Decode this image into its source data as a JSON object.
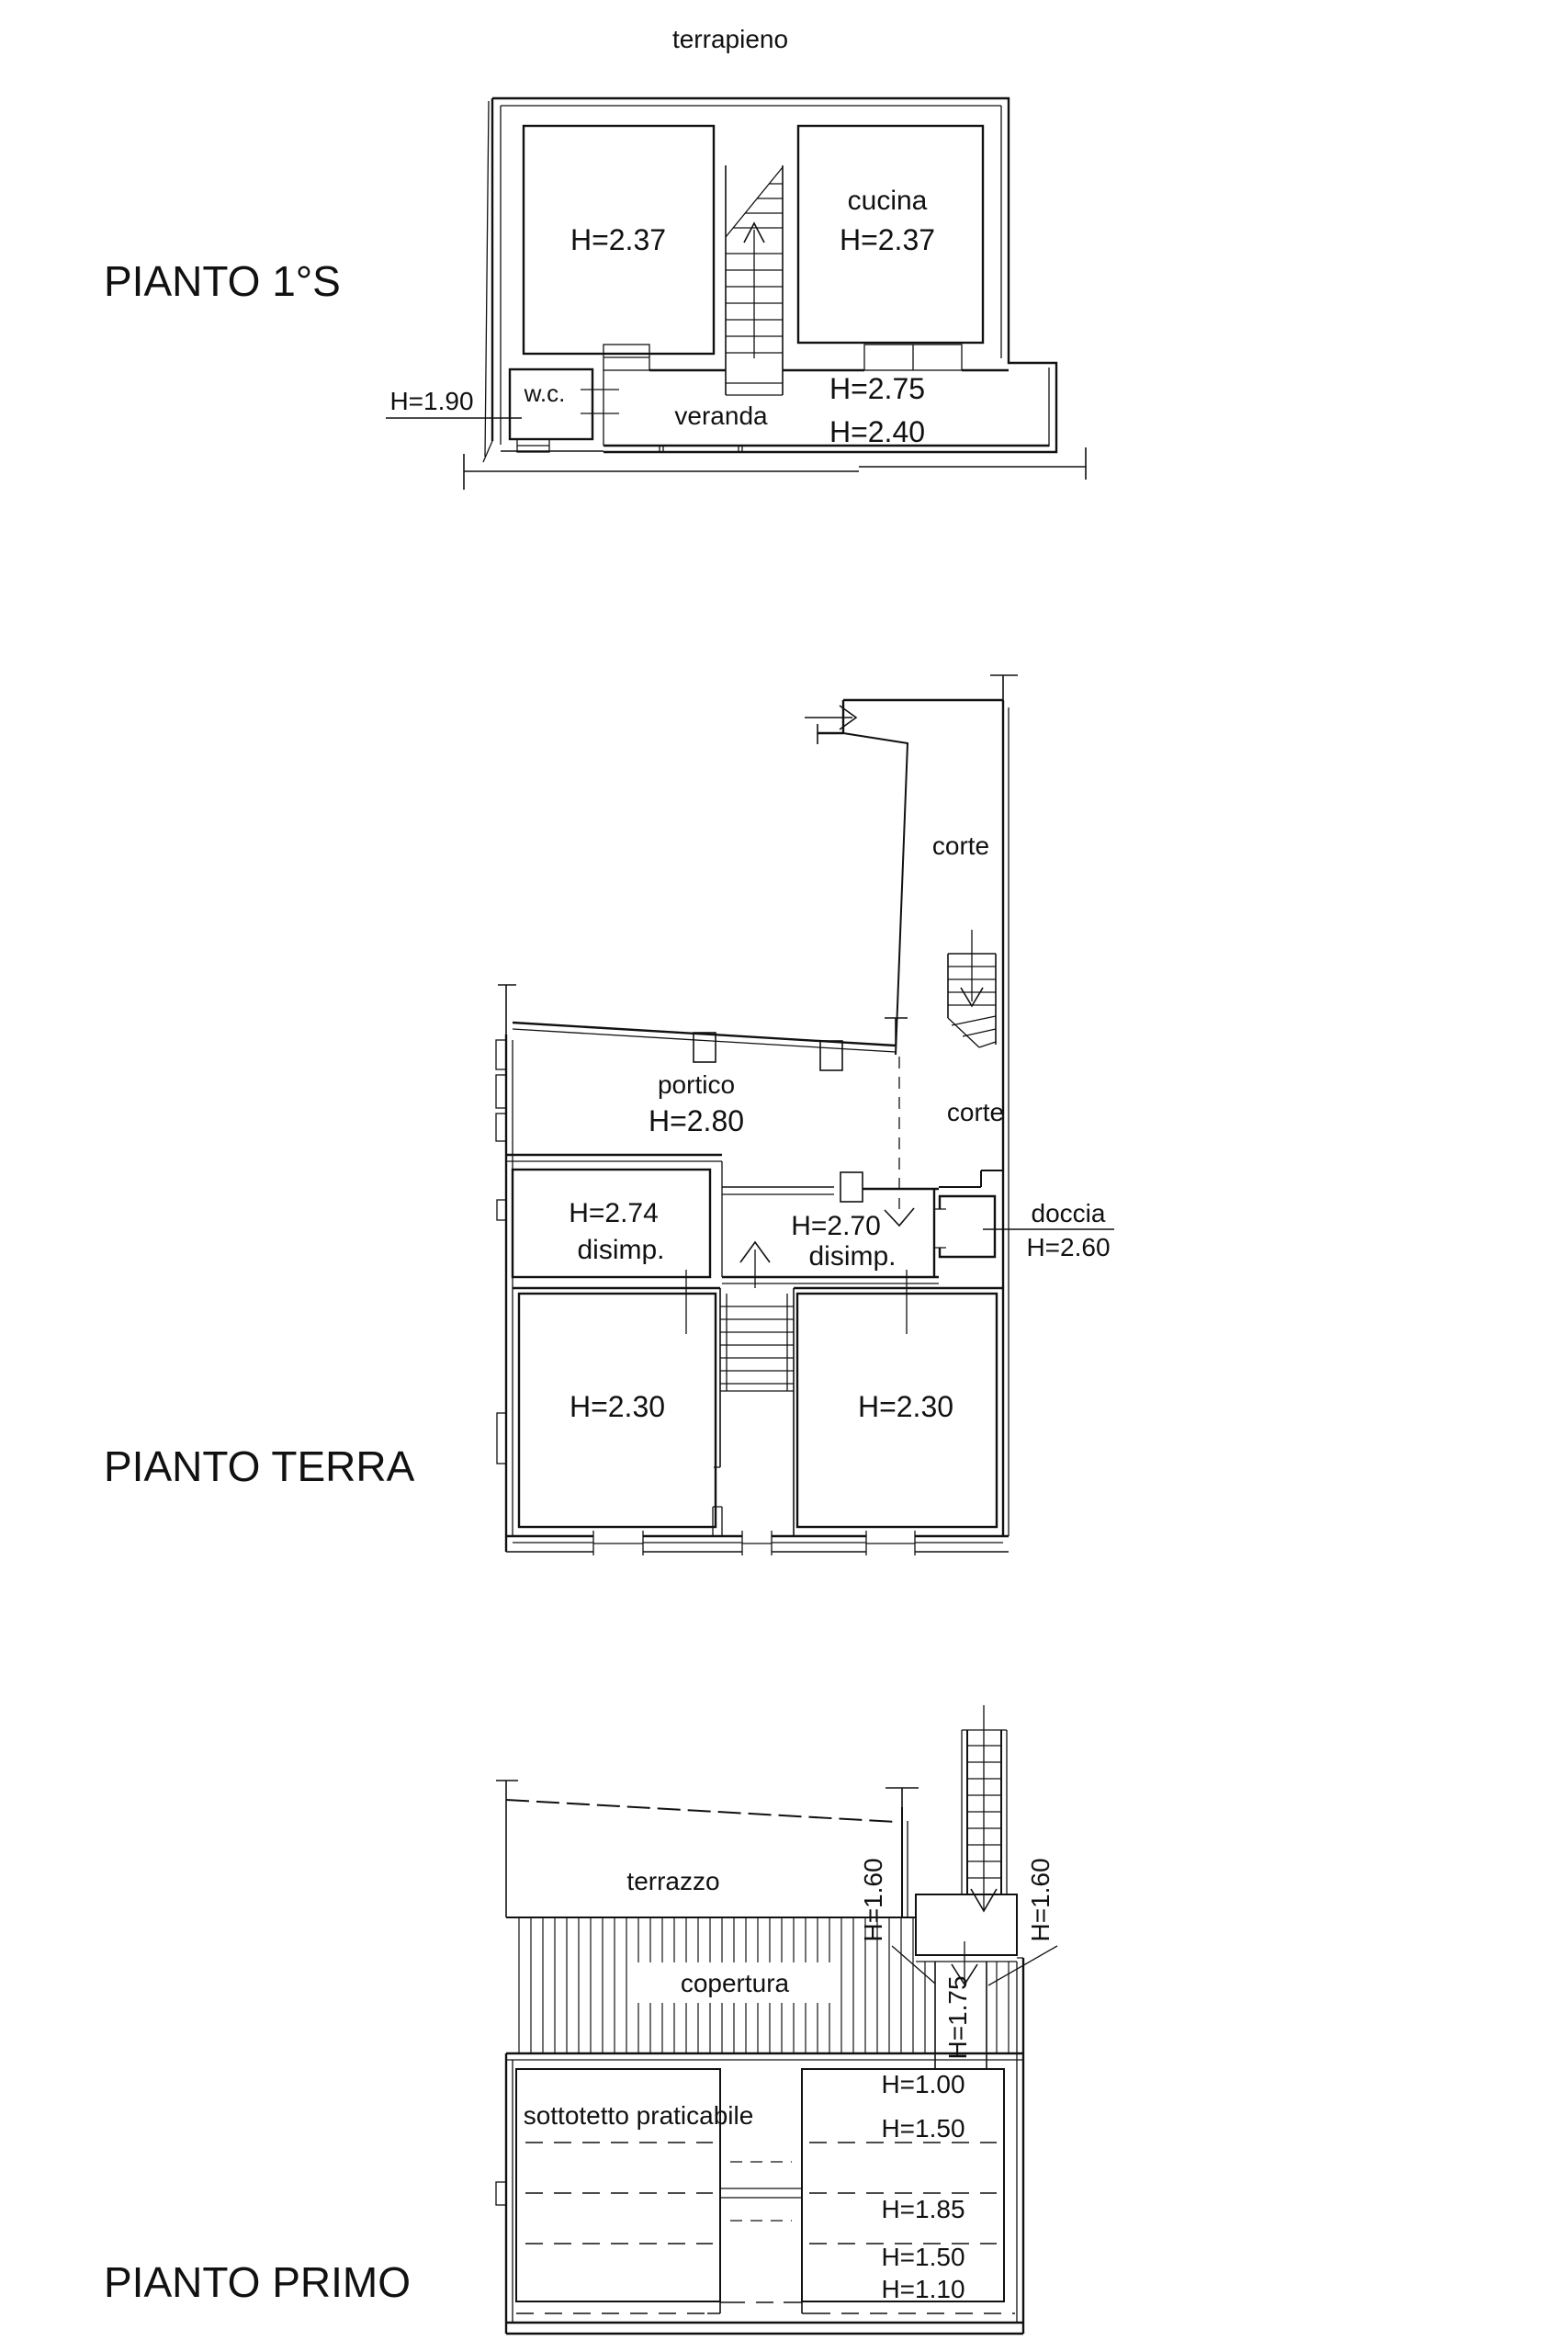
{
  "page": {
    "background": "#ffffff",
    "ink": "#111111"
  },
  "plans": {
    "seminterrato": {
      "title": "PIANTO 1°S",
      "labels": {
        "terrapieno": "terrapieno",
        "room_left_h": "H=2.37",
        "cucina": "cucina",
        "cucina_h": "H=2.37",
        "wc": "w.c.",
        "wc_h": "H=1.90",
        "veranda": "veranda",
        "veranda_h1": "H=2.75",
        "veranda_h2": "H=2.40"
      }
    },
    "terra": {
      "title": "PIANTO TERRA",
      "labels": {
        "corte_upper": "corte",
        "portico": "portico",
        "portico_h": "H=2.80",
        "corte_lower": "corte",
        "disimp1_h": "H=2.74",
        "disimp1": "disimp.",
        "disimp2_h": "H=2.70",
        "disimp2": "disimp.",
        "doccia": "doccia",
        "doccia_h": "H=2.60",
        "room_left_h": "H=2.30",
        "room_right_h": "H=2.30"
      }
    },
    "primo": {
      "title": "PIANTO PRIMO",
      "labels": {
        "terrazzo": "terrazzo",
        "stair_h_left": "H=1.60",
        "stair_h_right": "H=1.60",
        "corridor_h": "H=1.75",
        "copertura": "copertura",
        "sottotetto": "sottotetto praticabile",
        "h1": "H=1.00",
        "h2": "H=1.50",
        "h3": "H=1.85",
        "h4": "H=1.50",
        "h5": "H=1.10"
      }
    }
  }
}
